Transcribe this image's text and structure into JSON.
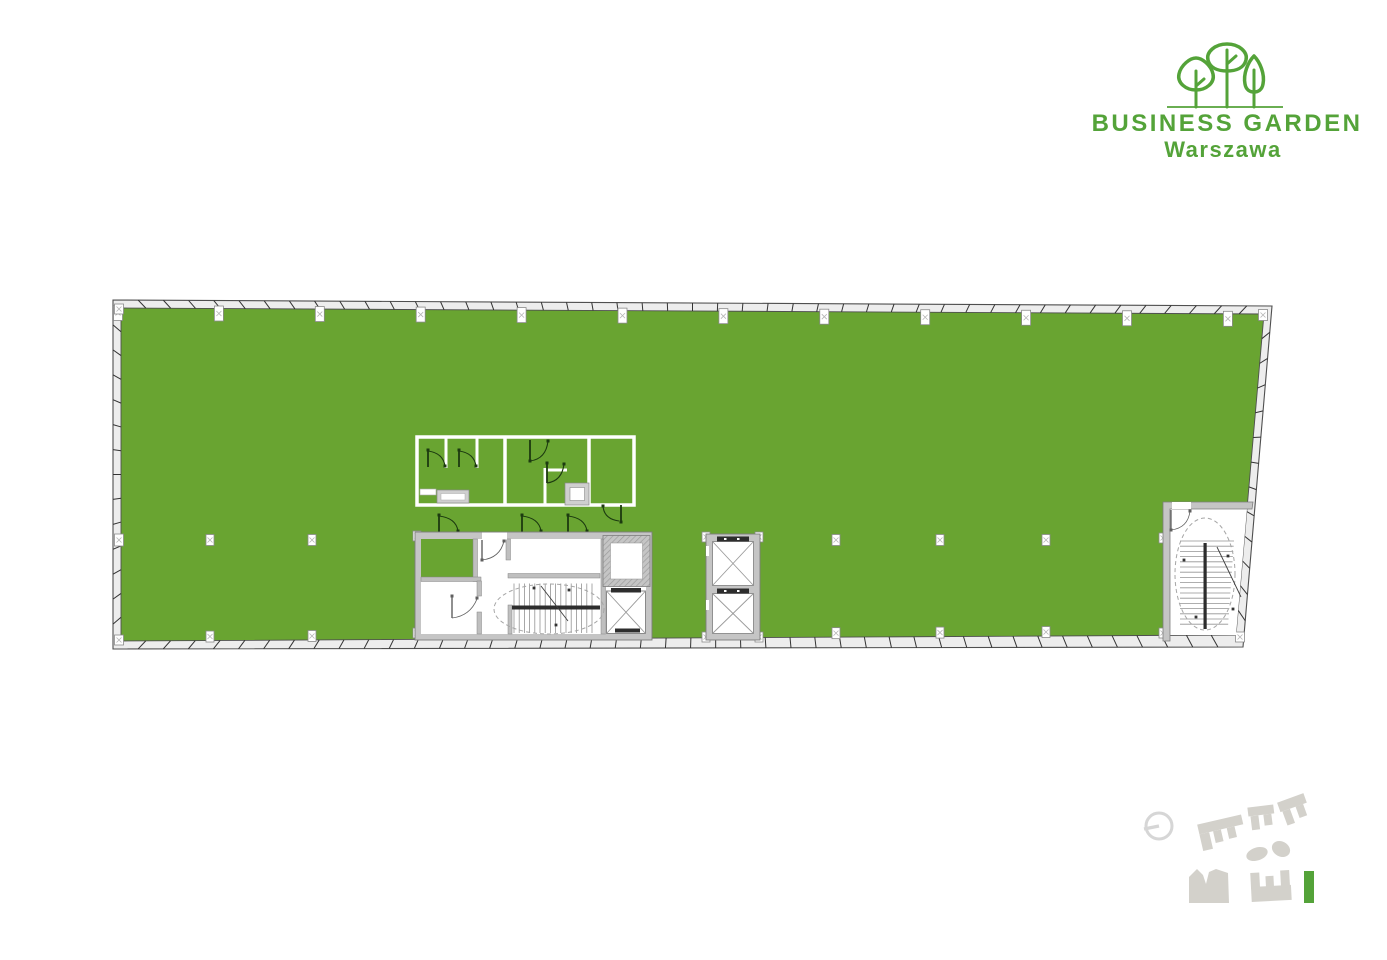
{
  "logo": {
    "title": "BUSINESS GARDEN",
    "subtitle": "Warszawa",
    "icon": "three-trees-icon"
  },
  "plan": {
    "kind": "office-floor-plan",
    "areas": {
      "open_space": "open office area",
      "sanitary_core": "toilet block",
      "main_core": "lobby with main staircase and elevator",
      "elevator_shafts": "double elevator shaft",
      "secondary_staircase": "east wing staircase",
      "columns": "structural column grid"
    }
  },
  "site_key": {
    "compass": "north-indicator-icon",
    "highlighted_building": "current building",
    "buildings": [
      "building-a",
      "building-b",
      "building-c",
      "building-d",
      "building-e",
      "building-f"
    ]
  },
  "colors": {
    "page_bg": "#ffffff",
    "plan_green": "#69a431",
    "logo_green": "#54a339",
    "facade_band": "#ededed",
    "facade_line": "#4f4f4f",
    "tick": "#333333",
    "wall_gray": "#c5c5c5",
    "wall_edge": "#7d7d7d",
    "inner_wall": "#bfbfbf",
    "hatch_line": "#9d9d9d",
    "door_dark": "#1c3a10",
    "door_gray": "#606060",
    "detail_dark": "#2d2d2d",
    "stair_line": "#939393",
    "dash_line": "#a6a6a6",
    "marker_edge": "#8a8a8a",
    "marker_x": "#b5b5b5",
    "fixture_gray": "#cfcfcf",
    "cab_cross": "#9a9a9a",
    "minimap_gray": "#d3d1cb",
    "compass_gray": "#d6d6d6",
    "white": "#ffffff"
  }
}
